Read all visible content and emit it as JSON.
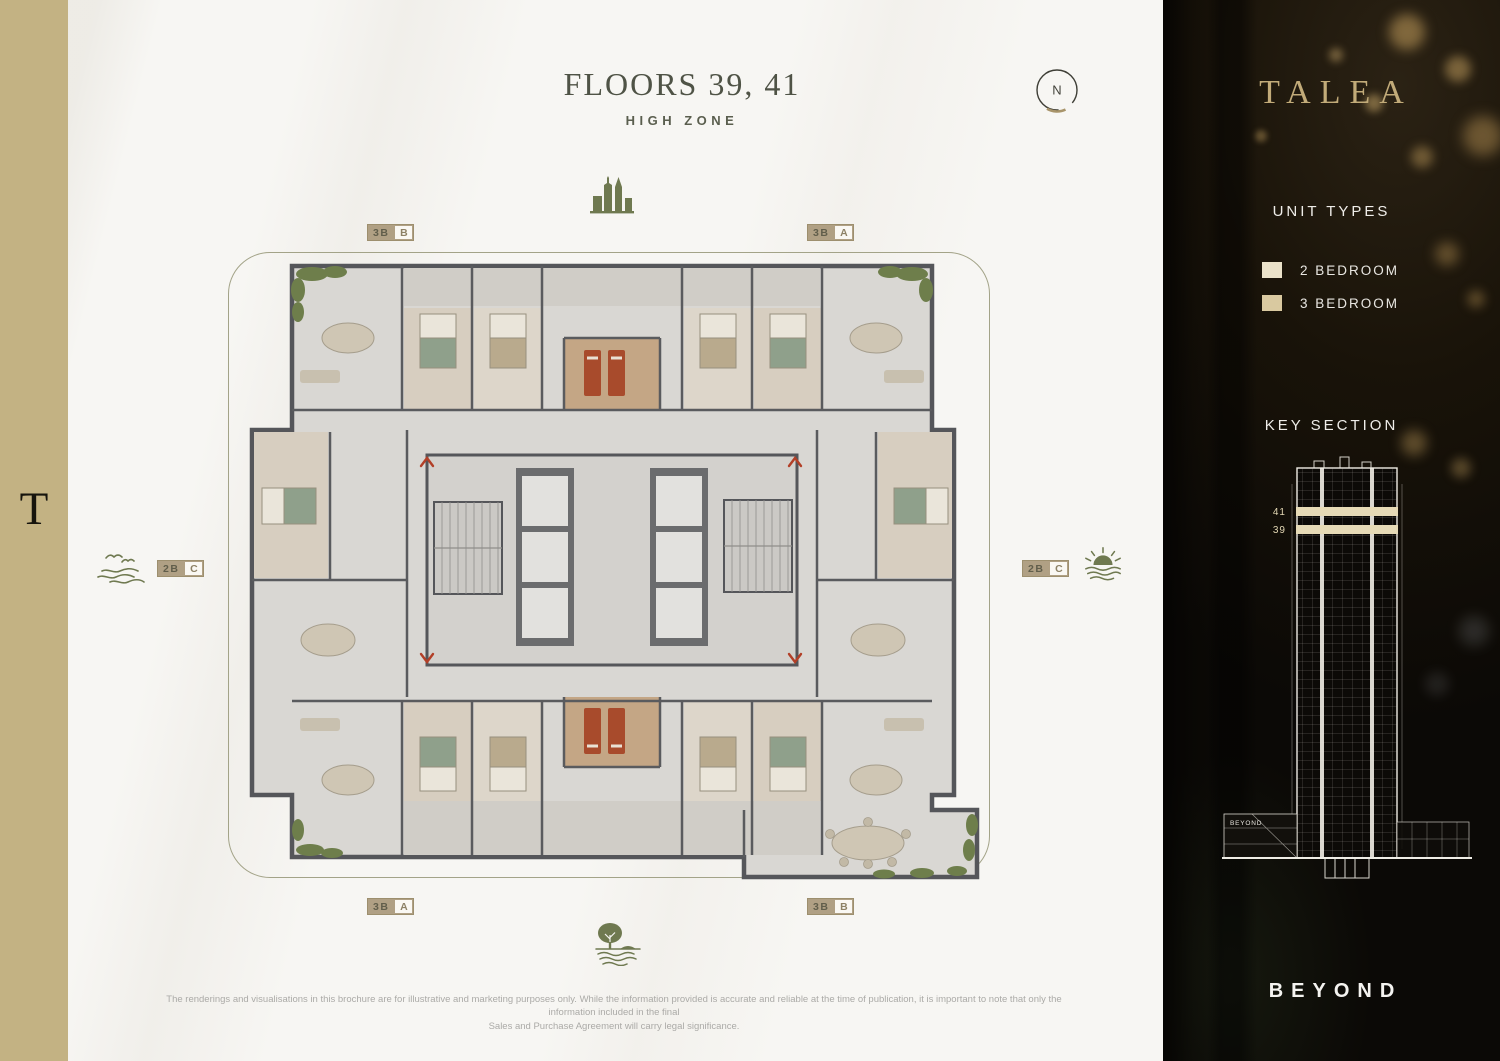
{
  "page": {
    "title": "FLOORS 39, 41",
    "subtitle": "HIGH ZONE",
    "compass_label": "N",
    "disclaimer": [
      "The renderings and visualisations in this brochure are for illustrative and marketing purposes only. While the information provided is accurate and reliable at the time of publication, it is important to note that only the information included in the final",
      "Sales and Purchase Agreement will carry legal significance."
    ]
  },
  "brand": {
    "strip_monogram": "T"
  },
  "plan": {
    "badges": [
      {
        "position": "top-left",
        "type": "3B",
        "letter": "B"
      },
      {
        "position": "top-right",
        "type": "3B",
        "letter": "A"
      },
      {
        "position": "left",
        "type": "2B",
        "letter": "C"
      },
      {
        "position": "right",
        "type": "2B",
        "letter": "C"
      },
      {
        "position": "bottom-left",
        "type": "3B",
        "letter": "A"
      },
      {
        "position": "bottom-right",
        "type": "3B",
        "letter": "B"
      }
    ],
    "view_icons": {
      "top": "city-skyline",
      "left": "seagulls-over-sea",
      "right": "sunset-over-sea",
      "bottom": "park-canal"
    }
  },
  "sidebar": {
    "brand": "TALEA",
    "unit_types": {
      "heading": "UNIT TYPES",
      "items": [
        {
          "label": "2 BEDROOM",
          "swatch": "#eae1c9"
        },
        {
          "label": "3 BEDROOM",
          "swatch": "#d9c9a0"
        }
      ]
    },
    "key_section": {
      "heading": "KEY SECTION",
      "floor_labels": [
        "41",
        "39"
      ],
      "podium_label": "BEYOND"
    },
    "footer_brand": "BEYOND"
  },
  "colors": {
    "accent_gold": "#b0a084",
    "olive": "#6f7950",
    "band_cream": "#e6dab6",
    "panel_bg": "#0e0b07"
  }
}
